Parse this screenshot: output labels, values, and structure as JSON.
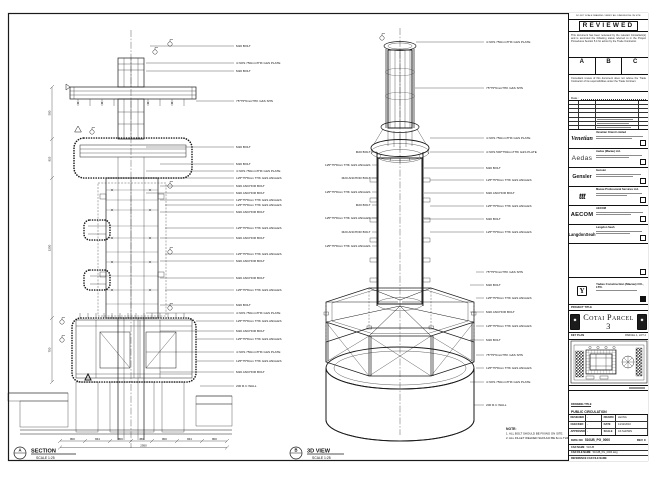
{
  "views": {
    "section": {
      "marker": "A",
      "title": "SECTION",
      "scale": "SCALE 1:25"
    },
    "iso": {
      "marker": "B",
      "title": "3D VIEW",
      "scale": "SCALE 1:25"
    }
  },
  "notes": {
    "title": "NOTE:",
    "item1": "1. ALL BOLT SHOULD BE FIXING ON SITE.",
    "item2": "2. ALL FILLET WELDED SHOULD BE 6mm THK."
  },
  "section_callouts": [
    "M20 BOLT",
    "4 NOS 750mmTHK G&S PLATE",
    "M20 BOLT",
    "75*75*6mmTHK G&S SHS",
    "M20 BOLT",
    "M20 BOLT",
    "4 NOS 750mmTHK G&S PLATE",
    "125*75*8mm THK G&S ANGLES",
    "M20 ANCHOR BOLT",
    "M20 ANCHOR BOLT",
    "125*75*8mm THK G&S ANGLES",
    "125*75*8mm THK G&S ANGLES",
    "M20 ANCHOR BOLT",
    "125*75*8mm THK G&S ANGLES",
    "M20 ANCHOR BOLT",
    "125*75*8mm THK G&S ANGLES",
    "M20 ANCHOR BOLT",
    "M20 ANCHOR BOLT",
    "125*75*8mm THK G&S ANGLES",
    "M20 BOLT",
    "4 NOS 750mmTHK G&S PLATE",
    "125*75*8mm THK G&S ANGLES",
    "M20 ANCHOR BOLT",
    "125*75*8mm THK G&S ANGLES",
    "4 NOS 750mmTHK G&S PLATE",
    "125*75*8mm THK G&S ANGLES",
    "M20 ANCHOR BOLT",
    "200 R.C WALL"
  ],
  "iso_callouts_right": [
    "4 NOS 750mmTHK G&S PLATE",
    "75*75*6mmTHK G&S SHS",
    "4 NOS 750mmTHK G&S PLATE",
    "4 NOS 500*750mmTHK G&S PLATE",
    "M20 BOLT",
    "125*75*8mm THK G&S ANGLES",
    "M20 ANCHOR BOLT",
    "125*75*8mm THK G&S ANGLES",
    "M20 BOLT",
    "125*75*8mm THK G&S ANGLES",
    "75*75*6mmTHK G&S SHS",
    "M20 BOLT",
    "125*75*8mm THK G&S ANGLES",
    "M20 ANCHOR BOLT",
    "125*75*8mm THK G&S ANGLES",
    "M20 BOLT",
    "75*75*6mmTHK G&S SHS",
    "125*75*8mm THK G&S ANGLES",
    "4 NOS 750mmTHK G&S PLATE",
    "200 R.C WALL"
  ],
  "iso_callouts_left": [
    "M20 BOLT",
    "125*75*8mm THK G&S ANGLES",
    "M20 ANCHOR BOLT",
    "125*75*8mm THK G&S ANGLES",
    "M20 BOLT",
    "125*75*8mm THK G&S ANGLES",
    "M20 ANCHOR BOLT",
    "125*75*8mm THK G&S ANGLES"
  ],
  "section_dims": {
    "segments": [
      "800",
      "844",
      "800",
      "450",
      "800",
      "844",
      "800"
    ],
    "total": "2950",
    "left": [
      "500",
      "825",
      "2250",
      "750"
    ]
  },
  "titleblock": {
    "top_strip": "DO NOT SCALE DRAWING. VERIFY ALL DIMENSIONS ON SITE.",
    "reviewed": {
      "title": "REVIEWED",
      "para1": "This document has been reviewed by the relevant Consultant(s) and is accorded the following status referred to in the Project Procedures Section 5.4 for action by the Trade Contractor.",
      "grades": [
        "A",
        "B",
        "C"
      ],
      "para2": "Consultant review of this document does not relieve the Trade Contractor of its responsibilities under the Trade Contract.",
      "date_label": "Date :"
    },
    "companies": [
      {
        "logo_text": "Venetian",
        "name": "Venetian Orient Limited"
      },
      {
        "logo_text": "Aedas",
        "name": "Aedas (Macau) Ltd."
      },
      {
        "logo_text": "Gensler",
        "name": "Gensler"
      },
      {
        "logo_text": "ttt",
        "name": "Macau Professional Services Ltd."
      },
      {
        "logo_text": "AECOM",
        "name": "AECOM"
      },
      {
        "logo_text": "LangdonSeah",
        "name": "Langdon Seah"
      }
    ],
    "contractor": {
      "logo_text": "Y",
      "name": "Yadao Construction (Macau) CO., LTD."
    },
    "project_title_label": "PROJECT TITLE",
    "project_title": "Cotai Parcel 3",
    "key_plan_label": "KEY PLAN",
    "key_plan_ref": "PARCEL 1, LOT 2",
    "drawing_title_label": "DRAWING TITLE",
    "drawing_title_lines": [
      "PUBLIC CIRCULATION",
      "FOUNTAIN DETAIL IN",
      "FOR STEEL DRAWING"
    ],
    "fields": {
      "designed_label": "DESIGNED",
      "designed": "-",
      "drawn_label": "DRAWN",
      "drawn": "LEUNG",
      "checked_label": "CHECKED",
      "checked": "-",
      "date_label": "DATE",
      "date": "14/12/2010",
      "approved_label": "APPROVED",
      "approved": "-",
      "scale_label": "SCALE",
      "scale": "AS SHOWN"
    },
    "dwg": {
      "no_label": "DWG NO",
      "no": "510UB_PG_0000",
      "rev": "REV C",
      "cad_name_label": "CAD NAME",
      "cad_name": "510UB",
      "cad_file_label": "CAD FILE NAME",
      "cad_file": "510UB_PG_0000.dwg",
      "ref_label": "REFERENCE CAD FILE NAME"
    }
  }
}
